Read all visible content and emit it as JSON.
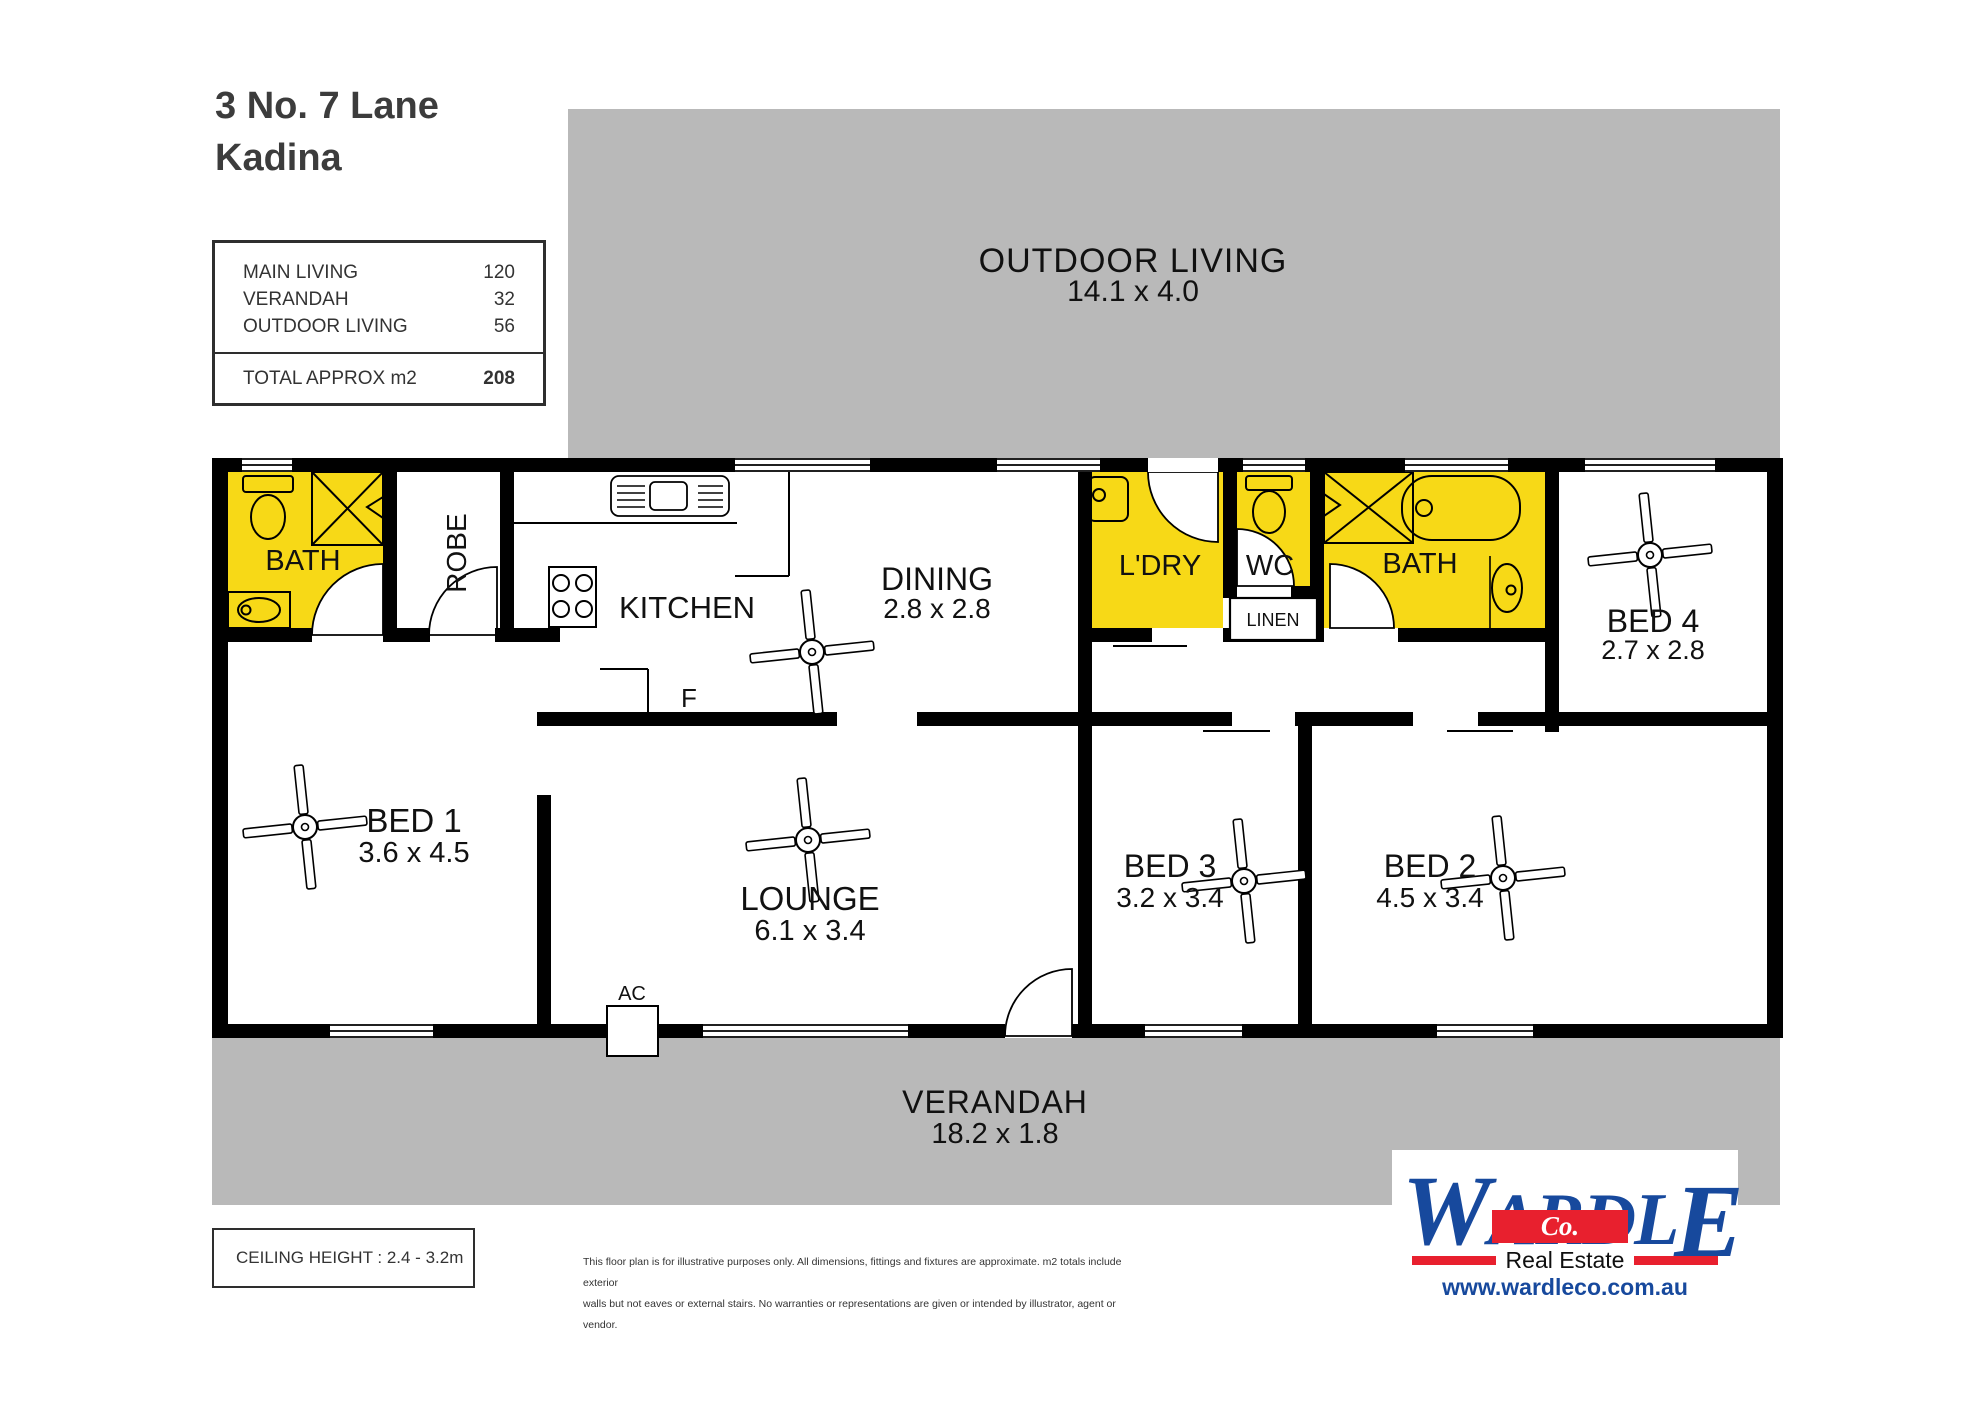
{
  "header": {
    "address_line1": "3 No. 7 Lane",
    "address_line2": "Kadina"
  },
  "area_table": {
    "rows": [
      {
        "label": "MAIN LIVING",
        "value": "120"
      },
      {
        "label": "VERANDAH",
        "value": "32"
      },
      {
        "label": "OUTDOOR LIVING",
        "value": "56"
      }
    ],
    "total": {
      "label": "TOTAL APPROX m2",
      "value": "208"
    }
  },
  "plan": {
    "outdoor_living": {
      "name": "OUTDOOR LIVING",
      "dims": "14.1 x 4.0"
    },
    "verandah": {
      "name": "VERANDAH",
      "dims": "18.2 x 1.8"
    },
    "rooms": {
      "bath1": {
        "name": "BATH"
      },
      "robe": {
        "name": "ROBE"
      },
      "kitchen": {
        "name": "KITCHEN"
      },
      "dining": {
        "name": "DINING",
        "dims": "2.8 x 2.8"
      },
      "ldry": {
        "name": "L'DRY"
      },
      "wc": {
        "name": "WC"
      },
      "linen": {
        "name": "LINEN"
      },
      "bath2": {
        "name": "BATH"
      },
      "bed4": {
        "name": "BED 4",
        "dims": "2.7 x 2.8"
      },
      "bed1": {
        "name": "BED 1",
        "dims": "3.6 x 4.5"
      },
      "lounge": {
        "name": "LOUNGE",
        "dims": "6.1 x 3.4"
      },
      "bed3": {
        "name": "BED 3",
        "dims": "3.2 x 3.4"
      },
      "bed2": {
        "name": "BED 2",
        "dims": "4.5 x 3.4"
      }
    },
    "labels": {
      "fridge": "F",
      "ac": "AC"
    }
  },
  "footer": {
    "ceiling_height": "CEILING HEIGHT : 2.4 - 3.2m",
    "disclaimer_line1": "This floor plan is for illustrative purposes only. All dimensions, fittings and fixtures are approximate. m2 totals include exterior",
    "disclaimer_line2": "walls but not eaves or external stairs. No warranties or representations are given or intended by illustrator, agent or vendor."
  },
  "branding": {
    "name_part1": "W",
    "name_part2": "ARDL",
    "name_part3": "E",
    "co": "Co.",
    "tagline": "Real Estate",
    "website": "www.wardleco.com.au",
    "blue": "#17499D",
    "red": "#E8202E"
  },
  "colors": {
    "highlight_yellow": "#F7D917",
    "area_gray": "#B9B9B9",
    "wall_black": "#000000"
  }
}
